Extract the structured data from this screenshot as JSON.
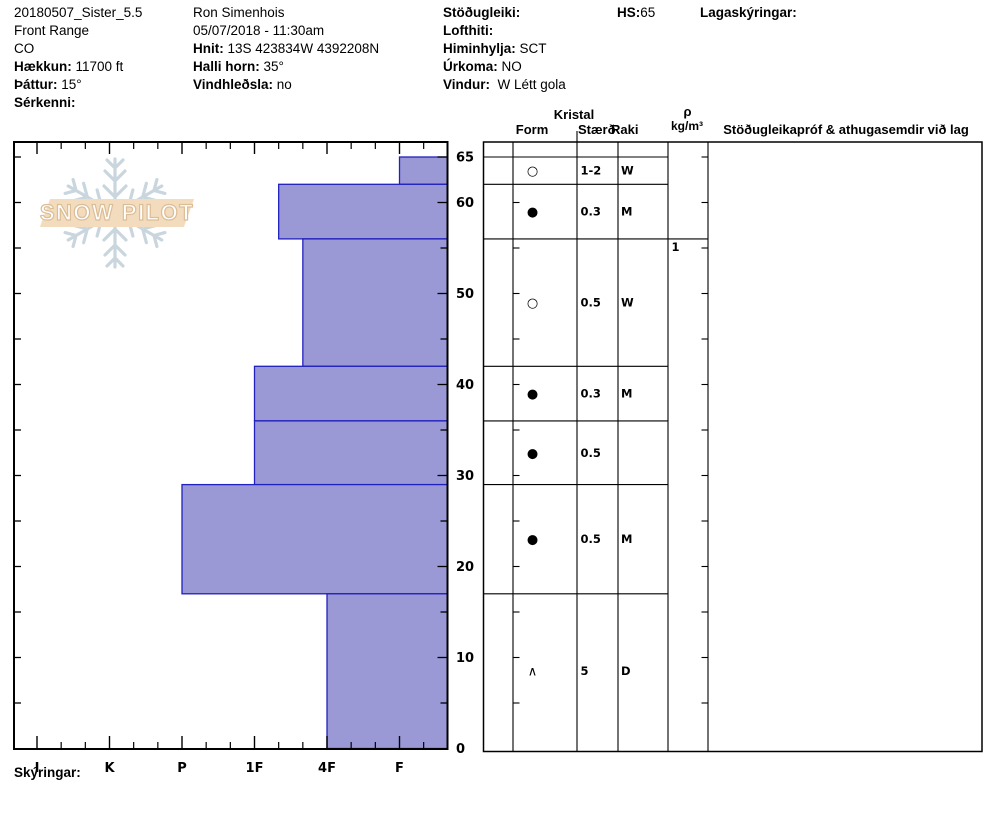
{
  "meta": {
    "col1": [
      {
        "label": "",
        "value": "20180507_Sister_5.5"
      },
      {
        "label": "",
        "value": "Front Range"
      },
      {
        "label": "",
        "value": "CO"
      },
      {
        "label": "Hækkun:",
        "value": " 11700 ft"
      },
      {
        "label": "Þáttur:",
        "value": " 15°"
      },
      {
        "label": "Sérkenni:",
        "value": ""
      }
    ],
    "col2": [
      {
        "label": "",
        "value": "Ron Simenhois"
      },
      {
        "label": "",
        "value": "05/07/2018 - 11:30am"
      },
      {
        "label": "Hnit:",
        "value": " 13S 423834W 4392208N"
      },
      {
        "label": "Halli horn:",
        "value": " 35°"
      },
      {
        "label": "Vindhleðsla:",
        "value": " no"
      }
    ],
    "col3": [
      {
        "label": "Stöðugleiki:",
        "value": ""
      },
      {
        "label": "Lofthiti:",
        "value": ""
      },
      {
        "label": "Himinhylja:",
        "value": " SCT"
      },
      {
        "label": "Úrkoma:",
        "value": " NO"
      },
      {
        "label": "Vindur:",
        "value": "  W Létt gola"
      }
    ],
    "hs": {
      "label": "HS:",
      "value": "65"
    },
    "layer_notes_label": "Lagaskýringar:"
  },
  "logo": {
    "text": "SNOW PILOT"
  },
  "footer": {
    "notes_label": "Skýringar:"
  },
  "chart_data": {
    "type": "bar",
    "title": "Snow hardness profile by depth",
    "orientation": "horizontal bars growing right-to-left (harder = longer)",
    "depth_axis": {
      "max": 65,
      "tick_labels": [
        65,
        60,
        50,
        40,
        30,
        20,
        10,
        0
      ],
      "minor_tick_step": 5
    },
    "hardness_axis": {
      "categories": [
        "I",
        "K",
        "P",
        "1F",
        "4F",
        "F"
      ],
      "minor_ticks_per_interval": 2
    },
    "layers": [
      {
        "top": 65,
        "bottom": 62,
        "hardness": "F",
        "form": "○",
        "size": "1-2",
        "moisture": "W"
      },
      {
        "top": 62,
        "bottom": 56,
        "hardness": "1F-",
        "form": "●",
        "size": "0.3",
        "moisture": "M"
      },
      {
        "top": 56,
        "bottom": 42,
        "hardness": "4F+",
        "form": "○",
        "size": "0.5",
        "moisture": "W"
      },
      {
        "top": 42,
        "bottom": 36,
        "hardness": "1F",
        "form": "●",
        "size": "0.3",
        "moisture": "M"
      },
      {
        "top": 36,
        "bottom": 29,
        "hardness": "1F",
        "form": "●",
        "size": "0.5",
        "moisture": ""
      },
      {
        "top": 29,
        "bottom": 17,
        "hardness": "P",
        "form": "●",
        "size": "0.5",
        "moisture": "M"
      },
      {
        "top": 17,
        "bottom": 0,
        "hardness": "4F",
        "form": "∧",
        "size": "5",
        "moisture": "D"
      }
    ],
    "table": {
      "group_header": "Kristal",
      "form_header": "Form",
      "size_header": "Stærð",
      "moisture_header": "Raki",
      "density_header_line1": "ρ",
      "density_header_line2": "kg/m³",
      "comments_header": "Stöðugleikapróf & athugasemdir við lag",
      "density_value": "1",
      "density_value_depth": 56
    },
    "colors": {
      "bar_fill": "#9a99d6",
      "bar_border": "#2121bd"
    }
  }
}
